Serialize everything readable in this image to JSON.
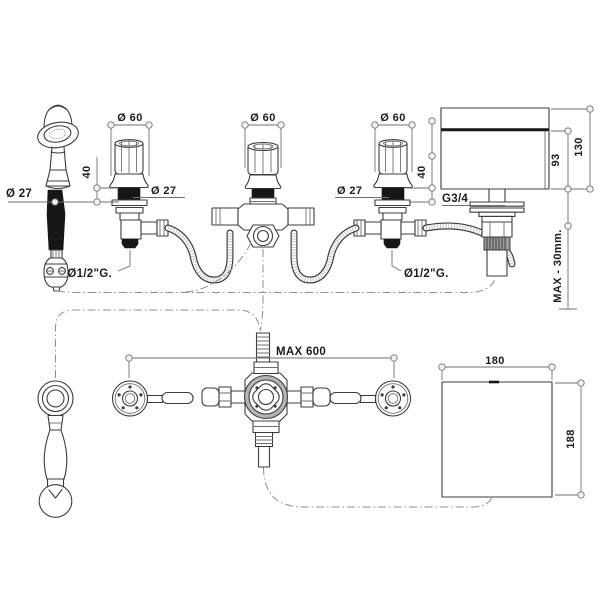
{
  "drawing": {
    "colors": {
      "line": "#3c3c3c",
      "dim_line": "#6f6f6f",
      "centerline": "#8f8f8f",
      "background": "#ffffff",
      "black_fill": "#161616"
    },
    "front_view": {
      "dia60_left": "Ø 60",
      "dia60_center": "Ø 60",
      "dia60_right": "Ø 60",
      "dia27_shower": "Ø 27",
      "dia27_left_valve": "Ø 27",
      "dia27_right_valve": "Ø 27",
      "height40_left": "40",
      "height40_right": "40",
      "thread_spout": "G3/4",
      "dim_93": "93",
      "dim_130": "130",
      "max_deck_thickness": "MAX - 30mm.",
      "inlet_left": "Ø1/2\"G.",
      "inlet_right": "Ø1/2\"G."
    },
    "plan_view": {
      "max_span": "MAX 600",
      "spout_width": "180",
      "spout_depth": "188"
    }
  }
}
